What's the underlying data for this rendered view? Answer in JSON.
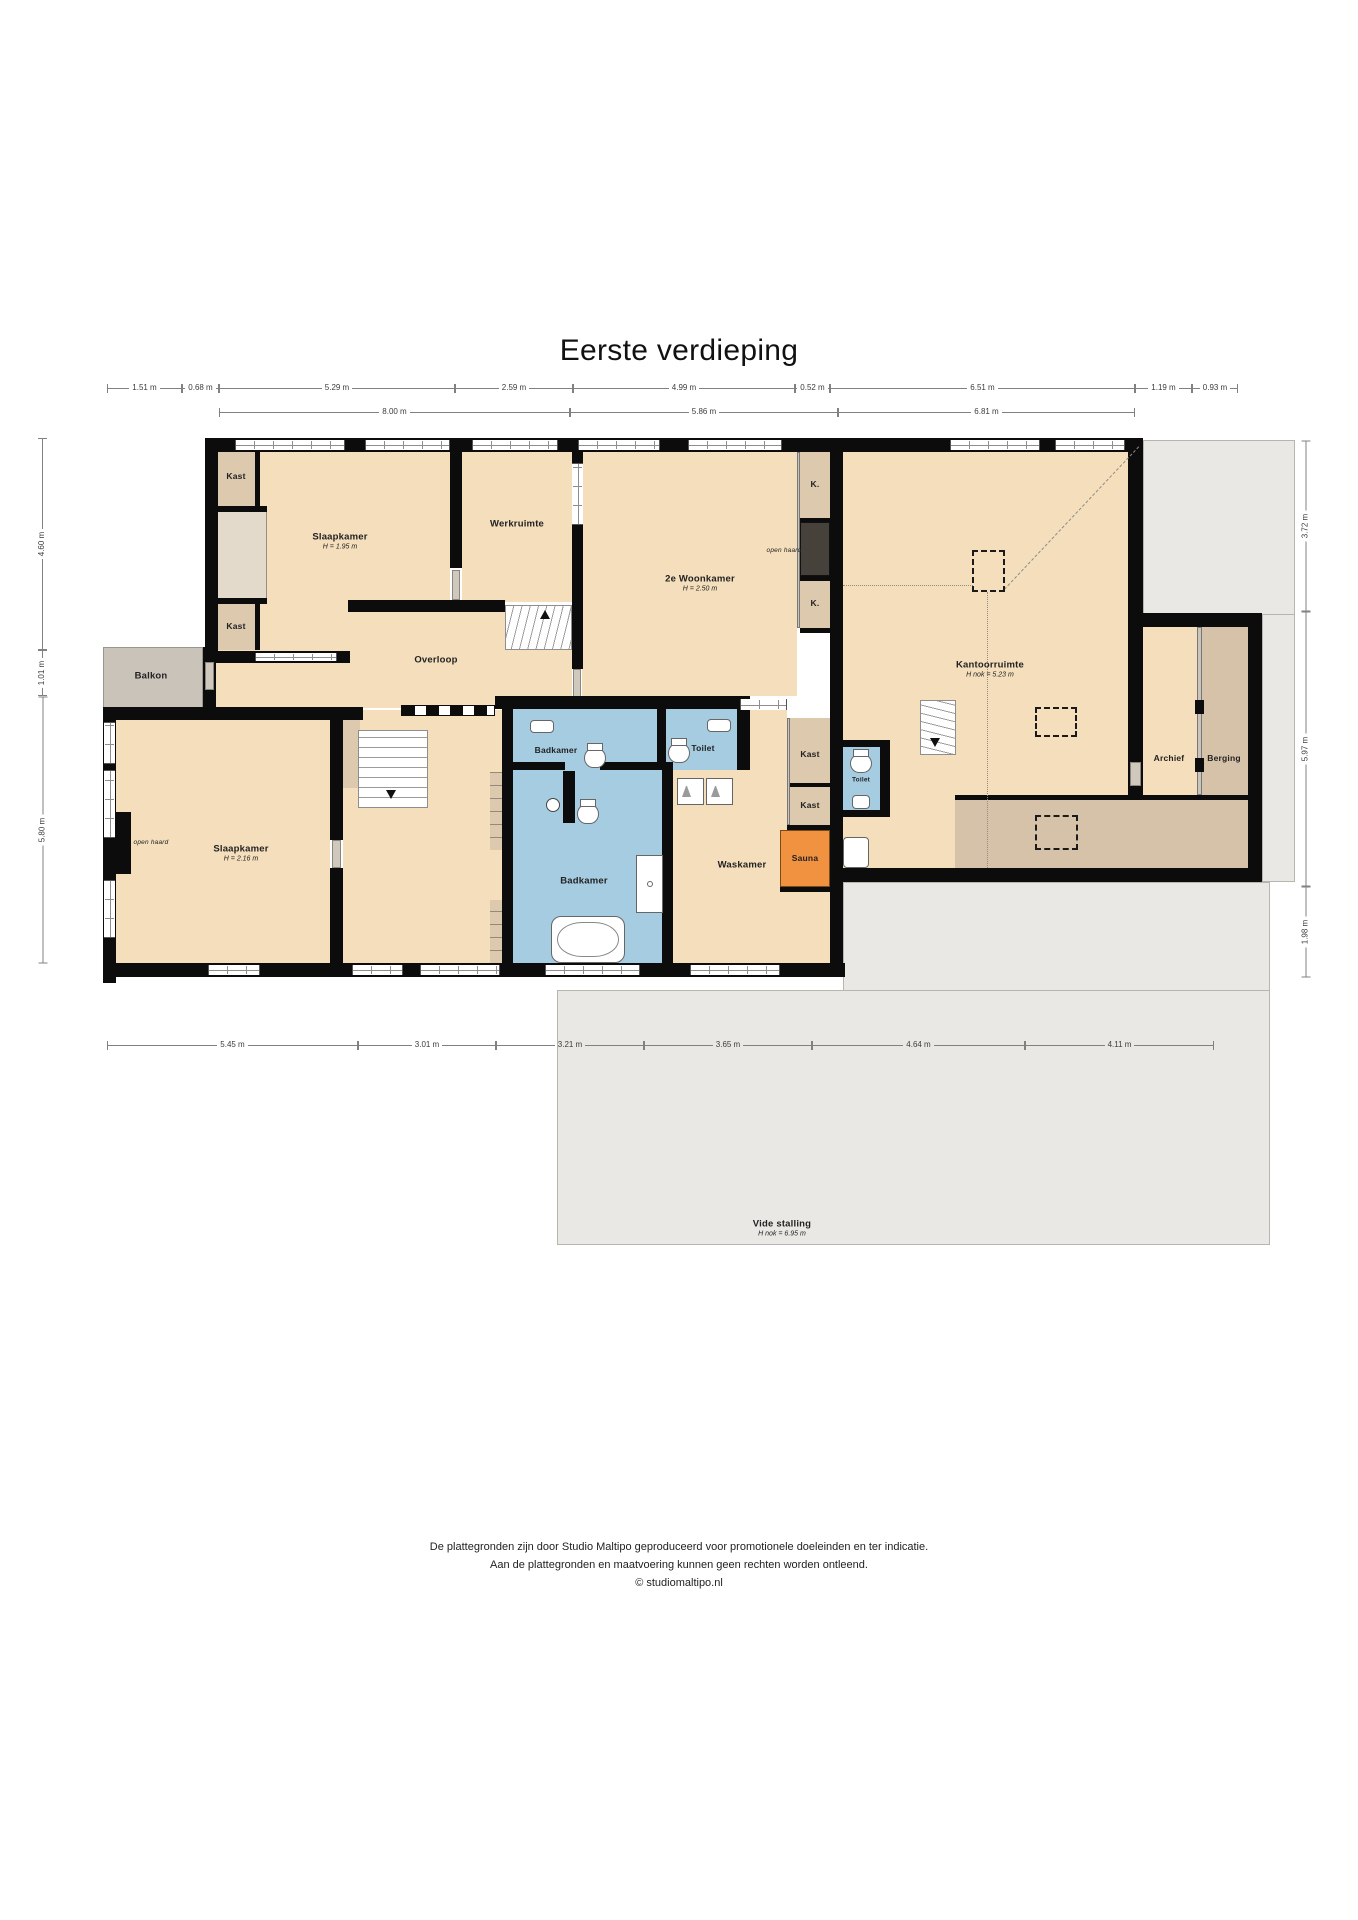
{
  "title": "Eerste verdieping",
  "footer": {
    "line1": "De plattegronden zijn door Studio Maltipo geproduceerd voor promotionele doeleinden en ter indicatie.",
    "line2": "Aan de plattegronden en maatvoering kunnen geen rechten worden ontleend.",
    "line3": "© studiomaltipo.nl"
  },
  "colors": {
    "wall": "#0c0c0c",
    "room_tan": "#f4debc",
    "closet_tan": "#dcc9ae",
    "storage_tan": "#d6c2a9",
    "balcony_grey": "#cac3ba",
    "outside_grey": "#eae8e4",
    "bathroom_blue": "#a6cce2",
    "sauna_orange": "#f09240",
    "fireplace_dark": "#46413a",
    "dimension_line": "#818181"
  },
  "rooms": [
    {
      "name": "room-label-slaapkamer-1",
      "label": "Slaapkamer",
      "sub": "H = 1.95 m",
      "x": 340,
      "y": 541
    },
    {
      "name": "room-label-kast-1",
      "label": "Kast",
      "x": 236,
      "y": 476,
      "small": true
    },
    {
      "name": "room-label-kast-2",
      "label": "Kast",
      "x": 236,
      "y": 626,
      "small": true
    },
    {
      "name": "room-label-werkruimte",
      "label": "Werkruimte",
      "x": 517,
      "y": 524
    },
    {
      "name": "room-label-2e-woonkamer",
      "label": "2e Woonkamer",
      "sub": "H = 2.50 m",
      "x": 700,
      "y": 583
    },
    {
      "name": "room-label-closet-k-1",
      "label": "K.",
      "x": 815,
      "y": 484,
      "small": true
    },
    {
      "name": "room-label-open-haard-1",
      "label": "open haard",
      "x": 784,
      "y": 551,
      "tiny": true
    },
    {
      "name": "room-label-closet-k-2",
      "label": "K.",
      "x": 815,
      "y": 603,
      "small": true
    },
    {
      "name": "room-label-kantoorruimte",
      "label": "Kantoorruimte",
      "sub": "H nok = 5.23 m",
      "x": 990,
      "y": 669
    },
    {
      "name": "room-label-overloop",
      "label": "Overloop",
      "x": 436,
      "y": 660
    },
    {
      "name": "room-label-balkon",
      "label": "Balkon",
      "x": 151,
      "y": 676
    },
    {
      "name": "room-label-slaapkamer-2",
      "label": "Slaapkamer",
      "sub": "H = 2.16 m",
      "x": 241,
      "y": 853
    },
    {
      "name": "room-label-open-haard-2",
      "label": "open haard",
      "x": 151,
      "y": 843,
      "tiny": true
    },
    {
      "name": "room-label-badkamer-1",
      "label": "Badkamer",
      "x": 556,
      "y": 750,
      "small": true
    },
    {
      "name": "room-label-toilet-1",
      "label": "Toilet",
      "x": 703,
      "y": 748,
      "small": true
    },
    {
      "name": "room-label-badkamer-2",
      "label": "Badkamer",
      "x": 584,
      "y": 881
    },
    {
      "name": "room-label-waskamer",
      "label": "Waskamer",
      "x": 742,
      "y": 865
    },
    {
      "name": "room-label-kast-3",
      "label": "Kast",
      "x": 810,
      "y": 754,
      "small": true
    },
    {
      "name": "room-label-kast-4",
      "label": "Kast",
      "x": 810,
      "y": 805,
      "small": true
    },
    {
      "name": "room-label-sauna",
      "label": "Sauna",
      "x": 805,
      "y": 858,
      "small": true
    },
    {
      "name": "room-label-toilet-2",
      "label": "Toilet",
      "x": 861,
      "y": 780,
      "t2": true
    },
    {
      "name": "room-label-archief",
      "label": "Archief",
      "x": 1169,
      "y": 758,
      "small": true
    },
    {
      "name": "room-label-berging",
      "label": "Berging",
      "x": 1224,
      "y": 758,
      "small": true
    },
    {
      "name": "room-label-vide-stalling",
      "label": "Vide stalling",
      "sub": "H nok = 6.95 m",
      "x": 782,
      "y": 1228
    }
  ],
  "dims": {
    "top_row_1": {
      "orientation": "horizontal",
      "y": 388,
      "segments": [
        [
          "1.51 m",
          107,
          182
        ],
        [
          "0.68 m",
          182,
          219
        ],
        [
          "5.29 m",
          219,
          455
        ],
        [
          "2.59 m",
          455,
          573
        ],
        [
          "4.99 m",
          573,
          795
        ],
        [
          "0.52 m",
          795,
          830
        ],
        [
          "6.51 m",
          830,
          1135
        ],
        [
          "1.19 m",
          1135,
          1192
        ],
        [
          "0.93 m",
          1192,
          1238
        ]
      ]
    },
    "top_row_2": {
      "orientation": "horizontal",
      "y": 412,
      "segments": [
        [
          "8.00 m",
          219,
          570
        ],
        [
          "5.86 m",
          570,
          838
        ],
        [
          "6.81 m",
          838,
          1135
        ]
      ]
    },
    "bottom": {
      "orientation": "horizontal",
      "y": 1045,
      "segments": [
        [
          "5.45 m",
          107,
          358
        ],
        [
          "3.01 m",
          358,
          496
        ],
        [
          "3.21 m",
          496,
          644
        ],
        [
          "3.65 m",
          644,
          812
        ],
        [
          "4.64 m",
          812,
          1025
        ],
        [
          "4.11 m",
          1025,
          1214
        ]
      ]
    },
    "left": {
      "orientation": "vertical",
      "x": 42,
      "segments": [
        [
          "4.60 m",
          438,
          650
        ],
        [
          "1.01 m",
          650,
          696
        ],
        [
          "5.80 m",
          696,
          963
        ]
      ]
    },
    "right": {
      "orientation": "vertical",
      "x": 1305,
      "segments": [
        [
          "3.72 m",
          440,
          611
        ],
        [
          "5.97 m",
          611,
          886
        ],
        [
          "1.98 m",
          886,
          977
        ]
      ]
    }
  }
}
